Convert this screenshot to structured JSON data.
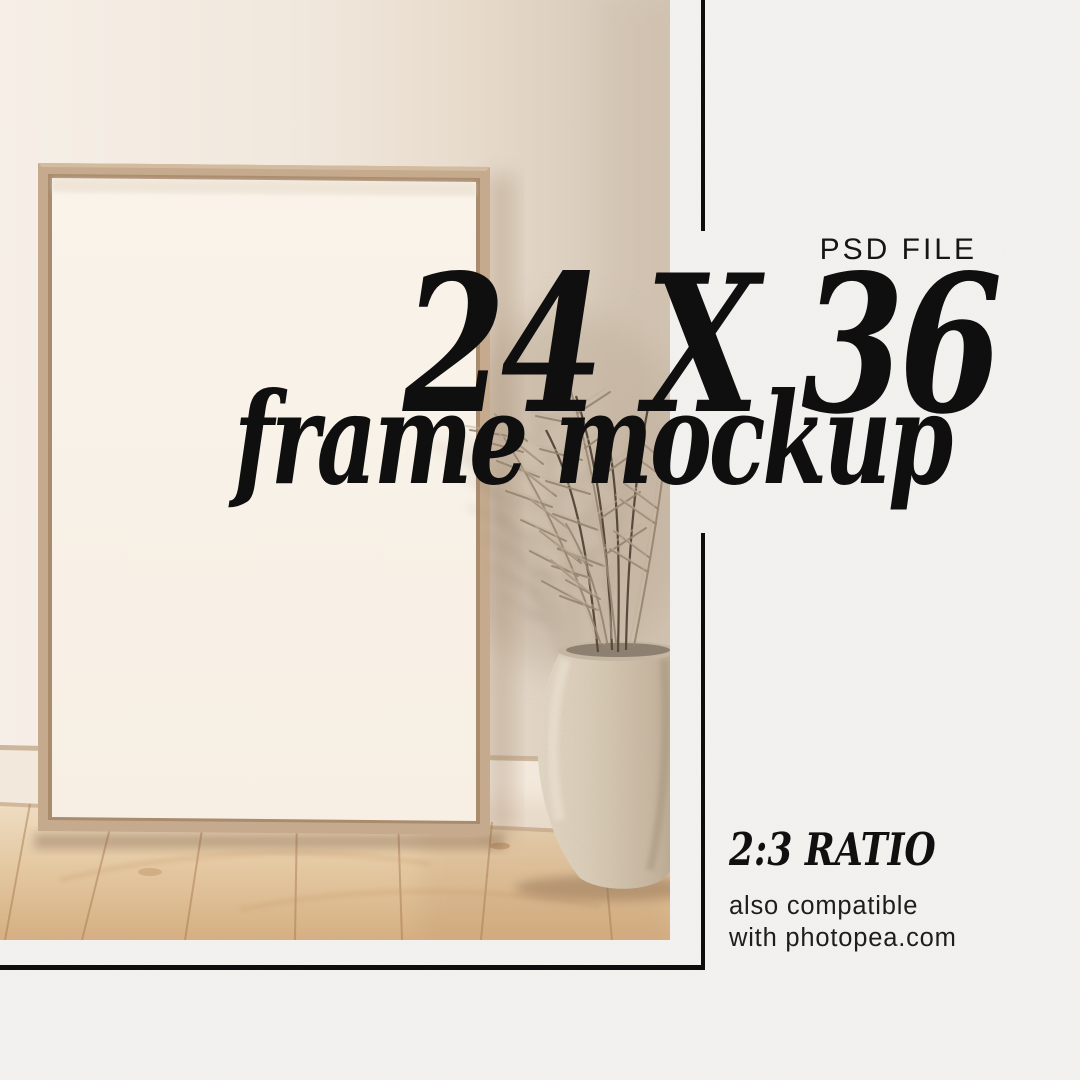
{
  "badge": {
    "psd_file": "PSD FILE"
  },
  "headline": {
    "size": "24 X 36",
    "subtitle": "frame mockup"
  },
  "details": {
    "ratio": "2:3 RATIO",
    "compat_line1": "also compatible",
    "compat_line2": "with photopea.com"
  },
  "colors": {
    "ink": "#0d0d0d",
    "paper": "#f3f2ef",
    "wall": "#f0e7db",
    "frame_wood": "#c7ac90",
    "poster": "#f9f3ea",
    "floor": "#e2c49c",
    "vase": "#d8cab5",
    "leaves": "#968470"
  },
  "scene": {
    "description": "empty wooden frame leaning on wall with dried palm plant in stone vase on oak floor"
  }
}
